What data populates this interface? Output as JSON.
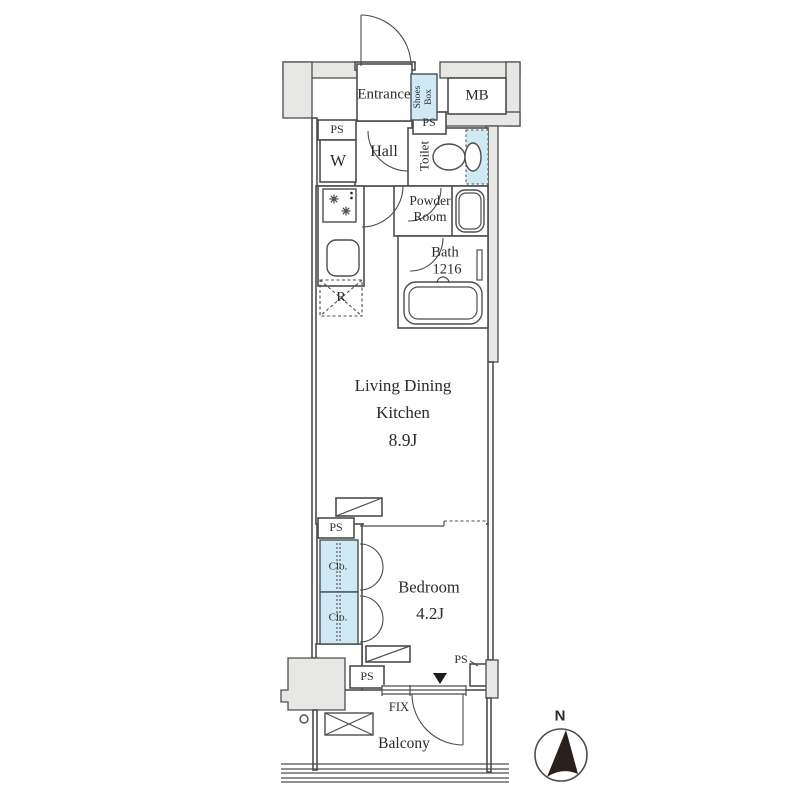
{
  "colors": {
    "wall_fill": "#e7e7e6",
    "accent_blue": "#cfe9f5",
    "line": "#4d4d4d",
    "text": "#2b2b2b",
    "needle": "#2a211d"
  },
  "rooms": {
    "entrance": "Entrance",
    "shoes_box": "Shoes Box",
    "meter_box": "MB",
    "laundry": "W",
    "hall": "Hall",
    "toilet": "Toilet",
    "powder_line1": "Powder",
    "powder_line2": "Room",
    "bath": "Bath",
    "bath_size": "1216",
    "fridge": "R",
    "ldk_line1": "Living Dining",
    "ldk_line2": "Kitchen",
    "ldk_size": "8.9J",
    "closet_upper": "Clo.",
    "closet_lower": "Clo.",
    "bedroom": "Bedroom",
    "bedroom_size": "4.2J",
    "balcony": "Balcony"
  },
  "annotations": {
    "ps": [
      "PS",
      "PS",
      "PS",
      "PS",
      "PS"
    ],
    "fix": "FIX",
    "north": "N"
  }
}
